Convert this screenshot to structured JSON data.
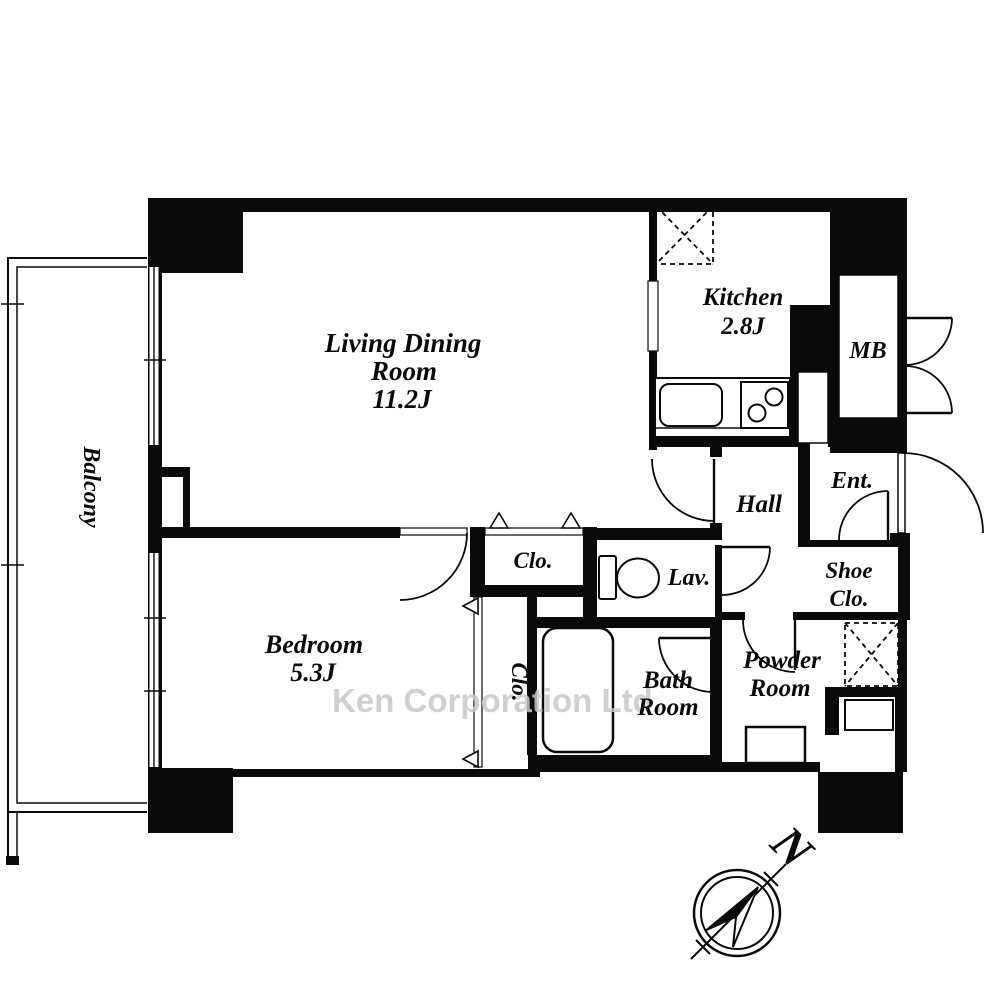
{
  "floorplan": {
    "title": "1LDK apartment floor plan",
    "watermark": "Ken Corporation Ltd.",
    "compass": {
      "north_label": "N"
    },
    "colors": {
      "walls": "#0a0a0a",
      "watermark_gray": "#c8c8c8",
      "background": "#ffffff"
    },
    "rooms": {
      "living_dining": {
        "line1": "Living Dining",
        "line2": "Room",
        "line3": "11.2J"
      },
      "kitchen": {
        "line1": "Kitchen",
        "line2": "2.8J"
      },
      "mb": {
        "label": "MB"
      },
      "ent": {
        "label": "Ent."
      },
      "hall": {
        "label": "Hall"
      },
      "shoe_clo": {
        "line1": "Shoe",
        "line2": "Clo."
      },
      "lav": {
        "label": "Lav."
      },
      "closet_hall": {
        "label": "Clo."
      },
      "closet_bedroom": {
        "label": "Clo."
      },
      "bedroom": {
        "line1": "Bedroom",
        "line2": "5.3J"
      },
      "bath": {
        "line1": "Bath",
        "line2": "Room"
      },
      "powder": {
        "line1": "Powder",
        "line2": "Room"
      },
      "balcony": {
        "label": "Balcony"
      }
    }
  }
}
